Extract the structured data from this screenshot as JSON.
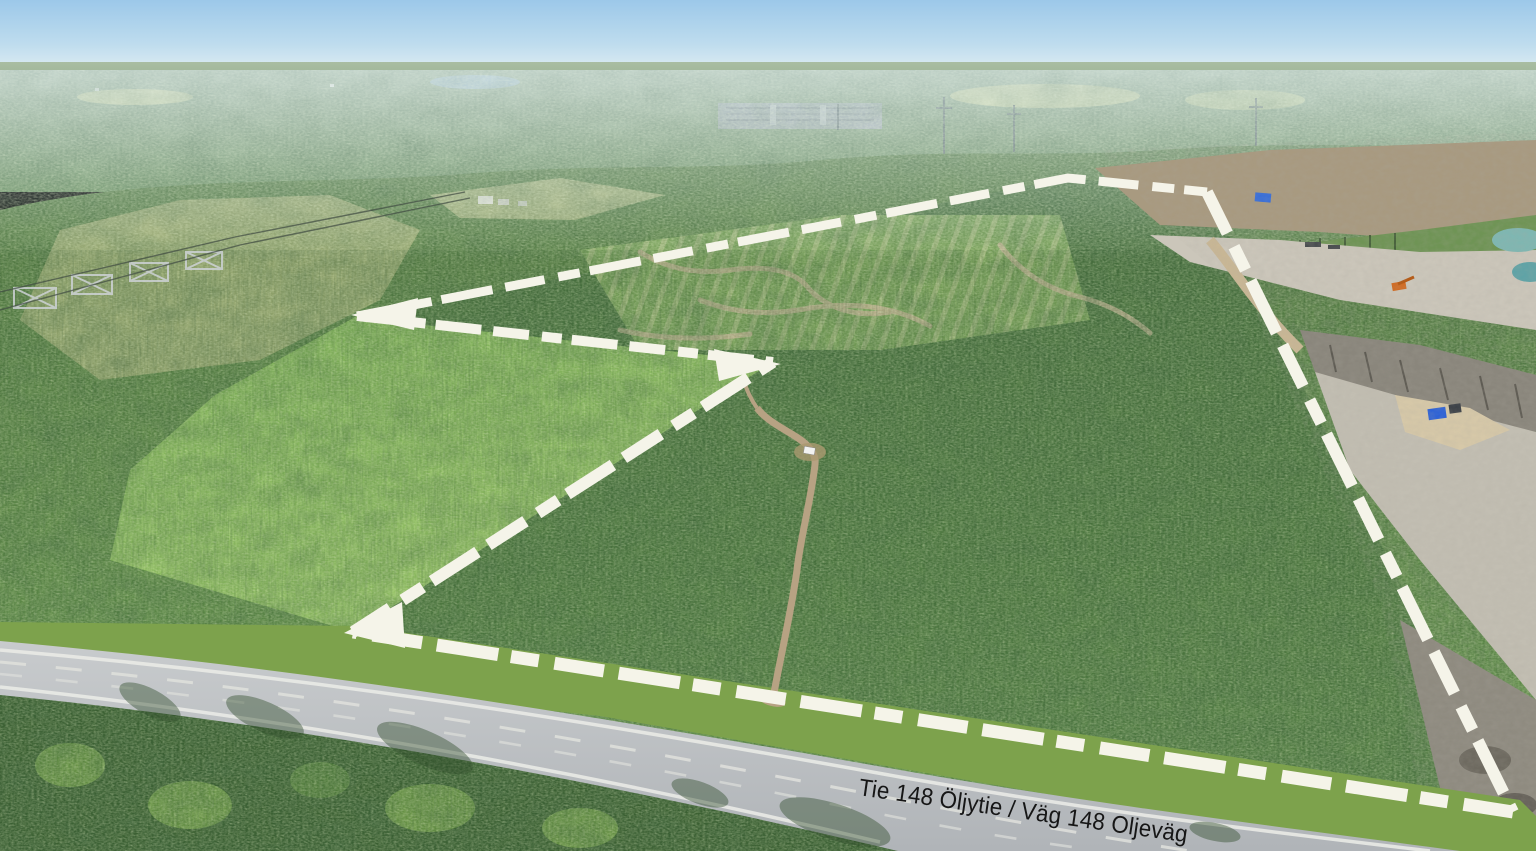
{
  "scene": {
    "type": "aerial-drone-photo",
    "setting": "Low-oblique aerial view of a forested land parcel outlined with a white dashed boundary, bordered in the foreground by highway 148 and on the east by a gravel quarry; clear-cut patches, a dirt access road with a parked white car, an electrical substation and power transmission lines are visible.",
    "sky": {
      "top": "#9cc8e9",
      "horizon": "#e8f1f4"
    },
    "colors": {
      "distant_forest": "#7c9a74",
      "forest_dark": "#4c7340",
      "forest_bright": "#8dbd60",
      "clearcut": "#a3b17b",
      "quarry_ground": "#c9c4b8",
      "quarry_rock": "#8a867c",
      "quarry_pond_teal": "#7fb7b2",
      "road_asphalt": "#bfc3c6",
      "road_marking": "#e9eae6",
      "dirt_road": "#b7a283",
      "grass_verge": "#7da24c",
      "field": "#ccd49e"
    },
    "features": [
      {
        "name": "property-boundary",
        "style": "white dashed outline with arrow-tip vertices",
        "vertices": [
          [
            357,
            316
          ],
          [
            1068,
            178
          ],
          [
            1207,
            192
          ],
          [
            1513,
            812
          ],
          [
            353,
            632
          ],
          [
            773,
            362
          ]
        ]
      },
      {
        "name": "main-road",
        "label": "Tie 148 Öljytie / Väg 148 Oljeväg"
      },
      {
        "name": "dirt-access-road"
      },
      {
        "name": "parked-white-car"
      },
      {
        "name": "gravel-quarry"
      },
      {
        "name": "quarry-ponds"
      },
      {
        "name": "excavator"
      },
      {
        "name": "blue-container"
      },
      {
        "name": "electrical-substation"
      },
      {
        "name": "power-transmission-lines"
      },
      {
        "name": "farm-buildings"
      },
      {
        "name": "clear-cut-patches"
      },
      {
        "name": "planted-sapling-rows"
      }
    ]
  },
  "overlay": {
    "road_label": "Tie 148 Öljytie / Väg 148 Oljeväg",
    "label_color": "#161616",
    "boundary_color": "#f5f4e9"
  }
}
